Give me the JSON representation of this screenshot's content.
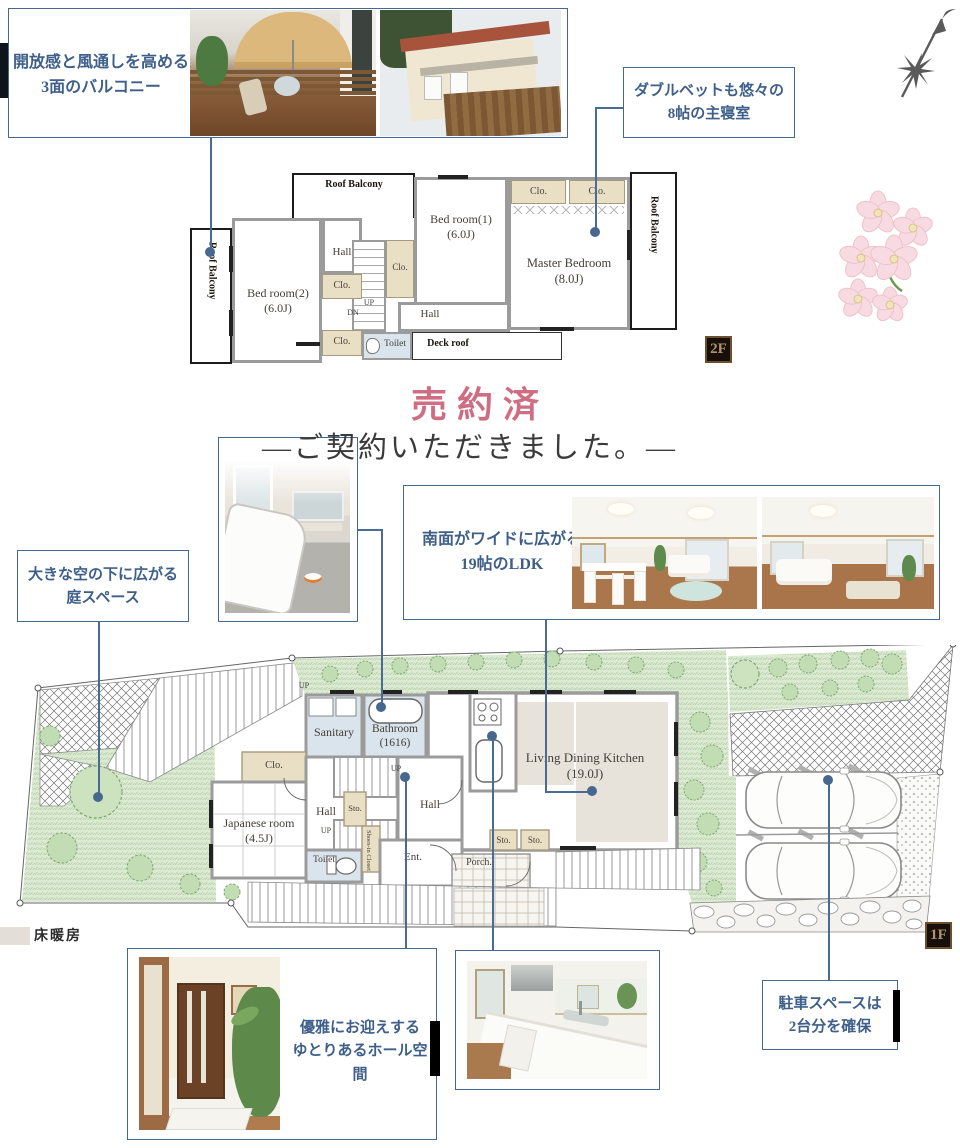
{
  "callouts": {
    "balcony": {
      "line1": "開放感と風通しを高める",
      "line2": "3面のバルコニー"
    },
    "master": {
      "line1": "ダブルベットも悠々の",
      "line2": "8帖の主寝室"
    },
    "garden": {
      "line1": "大きな空の下に広がる",
      "line2": "庭スペース"
    },
    "ldk": {
      "line1": "南面がワイドに広がる",
      "line2": "19帖のLDK"
    },
    "hall": {
      "line1": "優雅にお迎えする",
      "line2": "ゆとりあるホール空間"
    },
    "parking": {
      "line1": "駐車スペースは",
      "line2": "2台分を確保"
    }
  },
  "sold": {
    "title": "売約済",
    "subtitle": "―ご契約いただきました。―",
    "title_color": "#cf6d82"
  },
  "floor2": {
    "badge": "2F",
    "roof_balcony_top": "Roof Balcony",
    "roof_balcony_left": "Roof Balcony",
    "roof_balcony_right": "Roof Balcony",
    "bedroom1": "Bed room(1)",
    "bedroom1_size": "(6.0J)",
    "bedroom2": "Bed room(2)",
    "bedroom2_size": "(6.0J)",
    "master": "Master Bedroom",
    "master_size": "(8.0J)",
    "hall_upper": "Hall",
    "hall_lower": "Hall",
    "clo_mid": "Clo.",
    "clo_bottom": "Clo.",
    "clo_bed1": "Clo.",
    "clo_master_left": "Clo.",
    "clo_master_right": "Clo.",
    "up": "UP",
    "dn": "DN",
    "toilet": "Toilet",
    "deck_roof": "Deck roof"
  },
  "floor1": {
    "badge": "1F",
    "sanitary": "Sanitary",
    "bathroom": "Bathroom",
    "bathroom_size": "(1616)",
    "clo": "Clo.",
    "japanese": "Japanese room",
    "japanese_size": "(4.5J)",
    "hall_left": "Hall",
    "hall_right": "Hall",
    "sto_mid": "Sto.",
    "sto_1": "Sto.",
    "sto_2": "Sto.",
    "up_deck": "UP",
    "up_stairs_upper": "UP",
    "up_stairs_lower": "UP",
    "toilet": "Toilet",
    "shoes_closet": "Shoes-in Closet",
    "ent": "Ent.",
    "porch": "Porch.",
    "ldk": "Living Dining Kitchen",
    "ldk_size": "(19.0J)",
    "floor_heating": "床暖房"
  },
  "colors": {
    "accent": "#47688e",
    "leader": "#4a6b94"
  }
}
